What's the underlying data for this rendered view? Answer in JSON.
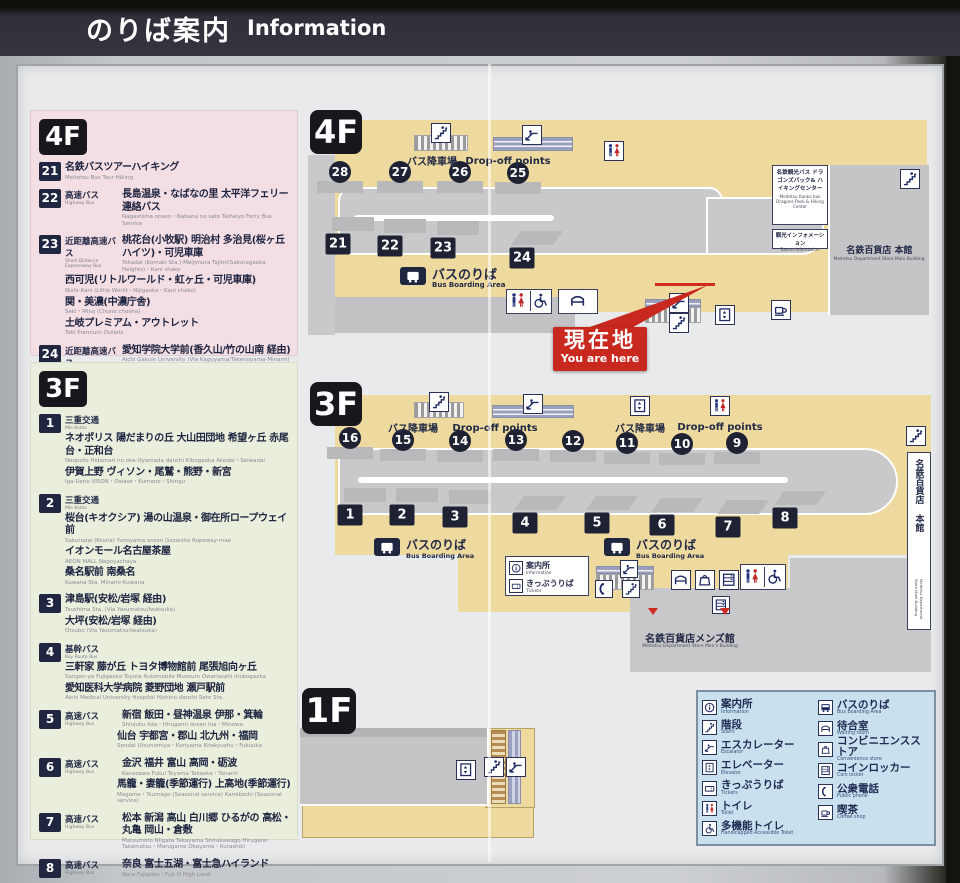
{
  "header": {
    "title_ja": "のりば案内",
    "title_en": "Information"
  },
  "you_are_here": {
    "ja": "現在地",
    "en": "You are here"
  },
  "floor4_panel": {
    "floor_label": "4F",
    "routes": [
      {
        "num": "21",
        "lines": [
          {
            "ja": "名鉄バスツアーハイキング",
            "en": "Meitetsu Bus Tour Hiking"
          }
        ]
      },
      {
        "num": "22",
        "lines": [
          {
            "t_ja": "高速バス",
            "t_en": "Highway Bus",
            "ja": "長島温泉・なばなの里 太平洋フェリー連絡バス",
            "en": "Nagashima onsen・Nabana no sato  Taiheiyo Ferry Bus Service"
          }
        ]
      },
      {
        "num": "23",
        "lines": [
          {
            "t_ja": "近距離高速バス",
            "t_en": "Short-Distance Expressway Bus",
            "ja": "桃花台(小牧駅) 明治村 多治見(桜ヶ丘ハイツ)・可児車庫",
            "en": "Tokadai (Komaki Sta.)  Meijimura  Tajimi(Sakuragaoka Heights)・Kani shako"
          },
          {
            "ja": "西可児(リトルワールド・虹ヶ丘・可児車庫)",
            "en": "Nishi-Kani (Little World・Nijigaoka・Kani shako)"
          },
          {
            "ja": "関・美濃(中濃庁舎)",
            "en": "Seki・Mino (Chuno chosha)"
          },
          {
            "ja": "土岐プレミアム・アウトレット",
            "en": "Toki Premium Outlets"
          }
        ]
      },
      {
        "num": "24",
        "lines": [
          {
            "t_ja": "近距離高速バス",
            "t_en": "Short-Distance Expressway Bus",
            "ja": "愛知学院大学前(香久山/竹の山南 経由)",
            "en": "Aichi Gakuin University (Via Kaguyama/Takenoyama-Minami)"
          },
          {
            "ja": "愛・地球博記念公園(ジブリパーク)",
            "en": "Ai-Chikyuhaku Kinen Koen (GHIBLI PARK)"
          }
        ]
      }
    ]
  },
  "floor3_panel": {
    "floor_label": "3F",
    "routes": [
      {
        "num": "1",
        "lines": [
          {
            "t_ja": "三重交通",
            "t_en": "Mie Kotsu"
          },
          {
            "ja": "ネオポリス 陽だまりの丘 大山田団地 希望ヶ丘 赤尾台・正和台",
            "en": "Neopolis  Hidamari no oka  Oyamada danchi  Kibogaoka  Akodai・Seiwadai"
          },
          {
            "ja": "伊賀上野 ヴィソン・尾鷲・熊野・新宮",
            "en": "Iga-Ueno  VISON・Owase・Kumano・Shingu"
          }
        ]
      },
      {
        "num": "2",
        "lines": [
          {
            "t_ja": "三重交通",
            "t_en": "Mie Kotsu"
          },
          {
            "ja": "桜台(キオクシア) 湯の山温泉・御在所ロープウェイ前",
            "en": "Sakuradai (Kioxia)  Yunoyama onsen Gozaisho Ropeway-mae"
          },
          {
            "ja": "イオンモール名古屋茶屋",
            "en": "AEON MALL Nagoyachaya"
          },
          {
            "ja": "桑名駅前 南桑名",
            "en": "Kuwana Sta.  Minami-Kuwana"
          }
        ]
      },
      {
        "num": "3",
        "lines": [
          {
            "ja": "津島駅(安松/岩塚 経由)",
            "en": "Tsushima Sta. (Via Yasumatsu/Iwatsuka)"
          },
          {
            "ja": "大坪(安松/岩塚 経由)",
            "en": "Otsubo (Via Yasumatsu/Iwatsuka)"
          }
        ]
      },
      {
        "num": "4",
        "lines": [
          {
            "t_ja": "基幹バス",
            "t_en": "Key Route Bus"
          },
          {
            "ja": "三軒家 藤が丘 トヨタ博物館前 尾張旭向ヶ丘",
            "en": "Sangen-ya  Fujigaoka  Toyota Automobile Museum  Owariasahi mukogaoka"
          },
          {
            "ja": "愛知医科大学病院 菱野団地 瀬戸駅前",
            "en": "Aichi Medical University Hospital  Hishino danchi  Seto Sta."
          }
        ]
      },
      {
        "num": "5",
        "lines": [
          {
            "t_ja": "高速バス",
            "t_en": "Highway Bus",
            "ja": "新宿 飯田・昼神温泉 伊那・箕輪",
            "en": "Shinjuku  Iida・Hirugami onsen  Ina・Minowa"
          },
          {
            "ja": "仙台 宇都宮・郡山 北九州・福岡",
            "en": "Sendai  Utsunomiya・Koriyama  Kitakyushu・Fukuoka",
            "indent": true
          }
        ]
      },
      {
        "num": "6",
        "lines": [
          {
            "t_ja": "高速バス",
            "t_en": "Highway Bus",
            "ja": "金沢 福井 富山 高岡・砺波",
            "en": "Kanazawa  Fukui  Toyama  Takaoka・Tonami"
          },
          {
            "ja": "馬籠・妻籠(季節運行) 上高地(季節運行)",
            "en": "Magome・Tsumago (Seasonal service)  Kamikochi (Seasonal service)",
            "indent": true
          }
        ]
      },
      {
        "num": "7",
        "lines": [
          {
            "t_ja": "高速バス",
            "t_en": "Highway Bus",
            "ja": "松本 新潟 高山 白川郷 ひるがの 高松・丸亀 岡山・倉敷",
            "en": "Matsumoto  Niigata  Takayama  Shirakawago  Hirugano  Takamatsu・Marugame  Okayama・Kurashiki"
          }
        ]
      },
      {
        "num": "8",
        "lines": [
          {
            "t_ja": "高速バス",
            "t_en": "Highway Bus",
            "ja": "奈良 富士五湖・富士急ハイランド",
            "en": "Nara  Fujigoko・Fuji-Q High Land"
          }
        ]
      }
    ]
  },
  "map4f": {
    "floor": "4F",
    "dropoff_bays": [
      "28",
      "27",
      "26",
      "25"
    ],
    "boarding_bays": [
      "21",
      "22",
      "23",
      "24"
    ],
    "labels": {
      "dropoff_ja": "バス降車場",
      "dropoff_en": "Drop-off points",
      "boarding_ja": "バスのりば",
      "boarding_en": "Bus Boarding Area"
    },
    "facilities": {
      "kanko_ja": "名鉄観光バス ドラゴンズパック& ハイキングセンター",
      "kanko_en": "Meitetsu Kanko bus Dragons Pack & Hiking Center",
      "tourist_ja": "観光インフォメーション",
      "tourist_en": "Tourist Information",
      "dept_ja": "名鉄百貨店 本館",
      "dept_en": "Meitetsu Department Store Main Building"
    }
  },
  "map3f": {
    "floor": "3F",
    "dropoff_bays": [
      "16",
      "15",
      "14",
      "13",
      "12",
      "11",
      "10",
      "9"
    ],
    "boarding_bays": [
      "1",
      "2",
      "3",
      "4",
      "5",
      "6",
      "7",
      "8"
    ],
    "labels": {
      "dropoff_ja": "バス降車場",
      "dropoff_en": "Drop-off points",
      "boarding_ja": "バスのりば",
      "boarding_en": "Bus Boarding Area",
      "info_ja": "案内所",
      "info_en": "Information",
      "tickets_ja": "きっぷうりば",
      "tickets_en": "Tickets"
    },
    "facilities": {
      "mens_ja": "名鉄百貨店メンズ館",
      "mens_en": "Meitetsu Department Store Men's Building",
      "dept_ja": "名鉄百貨店 本館",
      "dept_en": "Meitetsu Department Store Main Building"
    }
  },
  "map1f": {
    "floor": "1F"
  },
  "legend": {
    "left": [
      {
        "icon": "info",
        "ja": "案内所",
        "en": "Information"
      },
      {
        "icon": "stairs",
        "ja": "階段",
        "en": "Stairs"
      },
      {
        "icon": "escalator",
        "ja": "エスカレーター",
        "en": "Escalator"
      },
      {
        "icon": "elevator",
        "ja": "エレベーター",
        "en": "Elevator"
      },
      {
        "icon": "tickets",
        "ja": "きっぷうりば",
        "en": "Tickets"
      },
      {
        "icon": "toilet",
        "ja": "トイレ",
        "en": "Toilet"
      },
      {
        "icon": "wheelchair",
        "ja": "多機能トイレ",
        "en": "Handicapped Accessible Toilet"
      }
    ],
    "right": [
      {
        "icon": "bus",
        "ja": "バスのりば",
        "en": "Bus Boarding Area"
      },
      {
        "icon": "waiting",
        "ja": "待合室",
        "en": "Waiting room"
      },
      {
        "icon": "convenience",
        "ja": "コンビニエンスストア",
        "en": "Convenience store"
      },
      {
        "icon": "locker",
        "ja": "コインロッカー",
        "en": "Coin locker"
      },
      {
        "icon": "phone",
        "ja": "公衆電話",
        "en": "Public phone"
      },
      {
        "icon": "coffee",
        "ja": "喫茶",
        "en": "Coffee shop"
      }
    ]
  },
  "icons": {
    "info": "circled-i",
    "stairs": "stair-steps",
    "escalator": "diagonal-steps",
    "elevator": "box-with-arrows",
    "tickets": "ticket",
    "toilet": "male-female-figures",
    "wheelchair": "wheelchair",
    "bus": "bus-front",
    "waiting": "bench-seat",
    "convenience": "shopping-bag",
    "locker": "locker-grid",
    "phone": "handset",
    "coffee": "coffee-cup"
  },
  "colors": {
    "header_bg": "#34343f",
    "navy": "#20263f",
    "red": "#c8281e",
    "floor_beige": "#eeda9f",
    "road_gray": "#c9c9cb",
    "panel4f_pink": "#f3dee4",
    "panel3f_green": "#e9efdc",
    "legend_blue": "#c9e1ef"
  }
}
